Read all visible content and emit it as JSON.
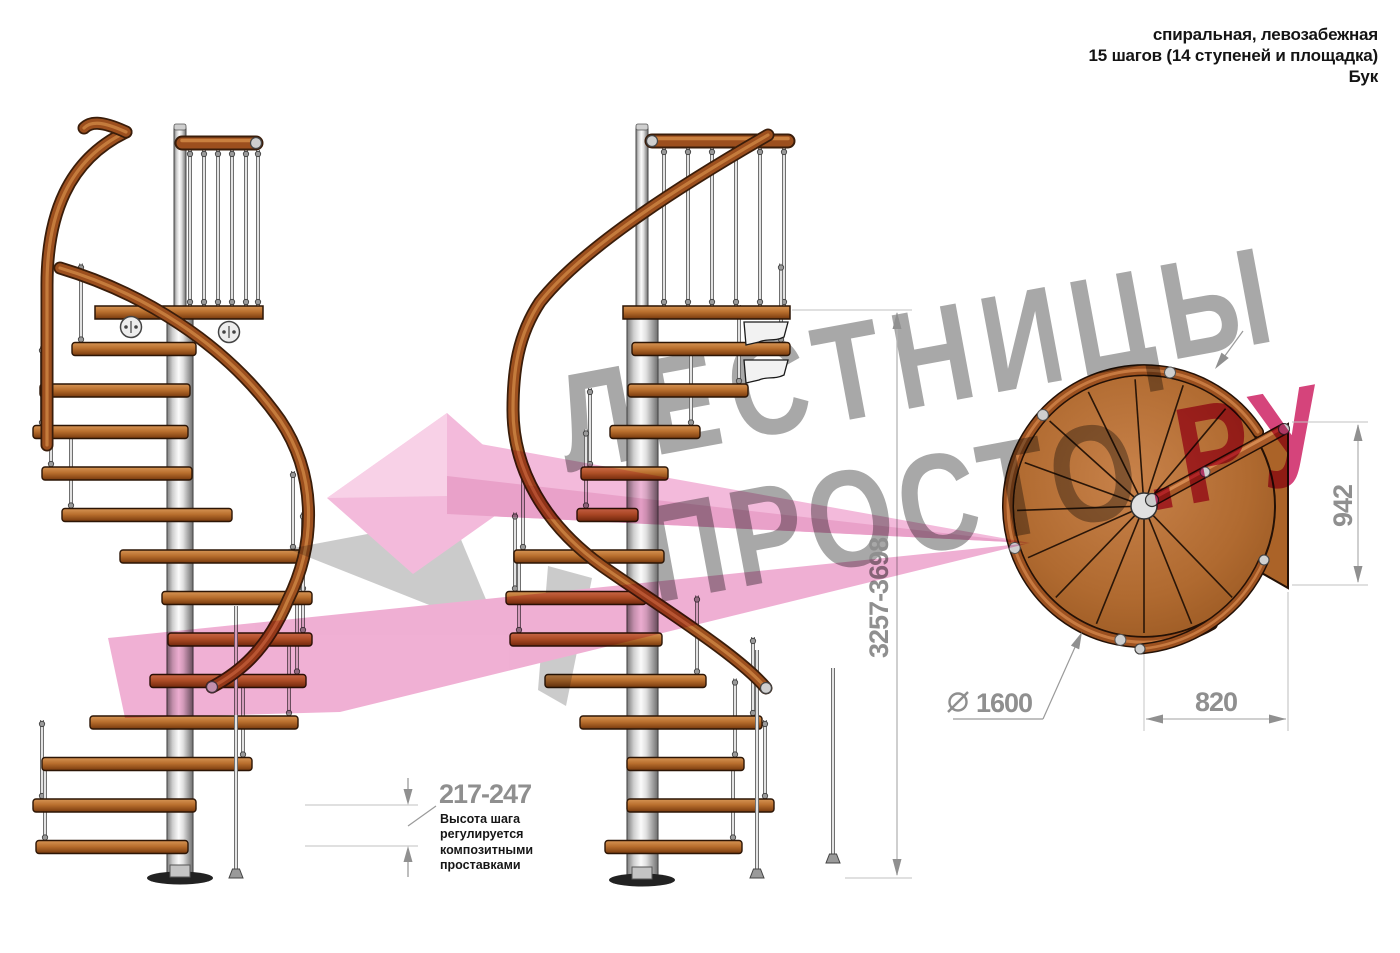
{
  "header": {
    "line1": "спиральная, левозабежная",
    "line2": "15 шагов (14 ступеней и площадка)",
    "line3": "Бук"
  },
  "watermark": {
    "line1": "ЛЕСТНИЦЫ",
    "line2_gray": "ПРОСТО",
    "line2_accent": ".РУ"
  },
  "dimensions": {
    "total_height": "3257-3698",
    "step_height": "217-247",
    "step_height_note": "Высота шага\nрегулируется\nкомпозитными\nпроставками",
    "landing_width": "942",
    "landing_depth": "820",
    "diameter": "1600",
    "diameter_symbol": "⌀"
  },
  "colors": {
    "dimension_gray": "#8f8f8f",
    "dimension_line": "#b5b5b5",
    "watermark_gray": "#a8a8a8",
    "watermark_accent": "#d5447b",
    "logo_pink": "#f2b3d7",
    "wood": "#9c4f1e",
    "wood_dark": "#3a1d0a",
    "metal": "#d9d9d9"
  }
}
